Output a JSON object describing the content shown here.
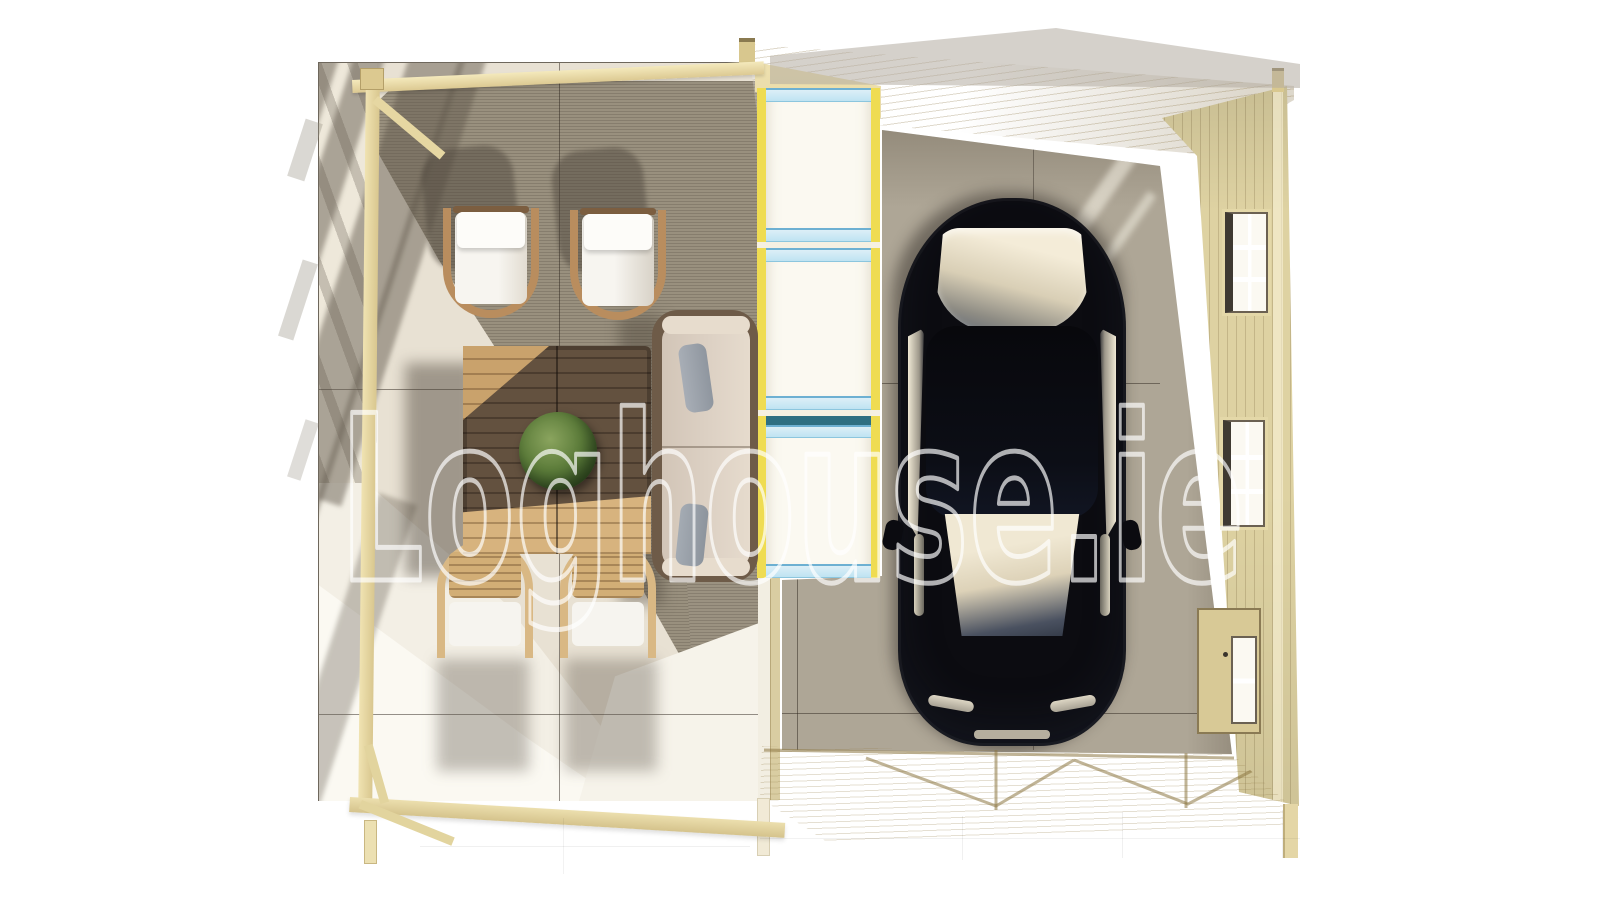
{
  "watermark": {
    "text": "Loghouse.ie"
  },
  "palette": {
    "background": "#ffffff",
    "timber_light": "#eee2b6",
    "timber_wall": "#ddd2a2",
    "paving_shaded": "#99907e",
    "paving_sunlit": "#f4f0e6",
    "garage_floor": "#aea696",
    "window_frame_yellow": "#efdc52",
    "window_glass_blue": "#bfe3f2",
    "window_glass_teal": "#2e6f82",
    "car_black": "#0c0c11",
    "car_glass": "#efe7d3",
    "plant_green": "#5c7c3a",
    "table_wood_dark": "#63513f",
    "table_wood_sunlit": "#cfa874",
    "sofa_cushion": "#dcd0c3",
    "watermark_stroke": "#ffffff"
  }
}
